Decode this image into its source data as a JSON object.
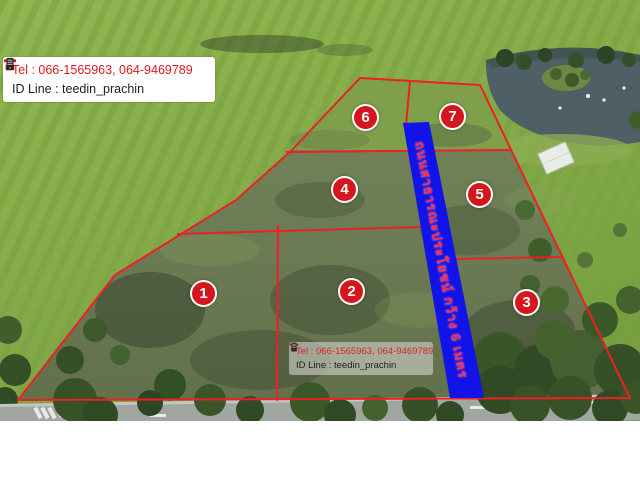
{
  "contact": {
    "tel": "Tel : 066-1565963, 064-9469789",
    "id_line": "ID Line : teedin_prachin"
  },
  "road_banner": {
    "text": "ถนนสาธารณะประโยชน์ กว้าง 6 เมตร"
  },
  "plots": [
    {
      "number": "1"
    },
    {
      "number": "2"
    },
    {
      "number": "3"
    },
    {
      "number": "4"
    },
    {
      "number": "5"
    },
    {
      "number": "6"
    },
    {
      "number": "7"
    }
  ],
  "icons": {
    "phone": "phone-icon",
    "id_line": "mobile-phone-icon"
  },
  "colors": {
    "boundary_red": "#ee1f26",
    "badge_red": "#d6161e",
    "banner_blue": "#1113e8",
    "banner_text_red": "#ff2e4a",
    "tel_text_red": "#e0191f",
    "id_text_dark": "#1d1d1d"
  }
}
